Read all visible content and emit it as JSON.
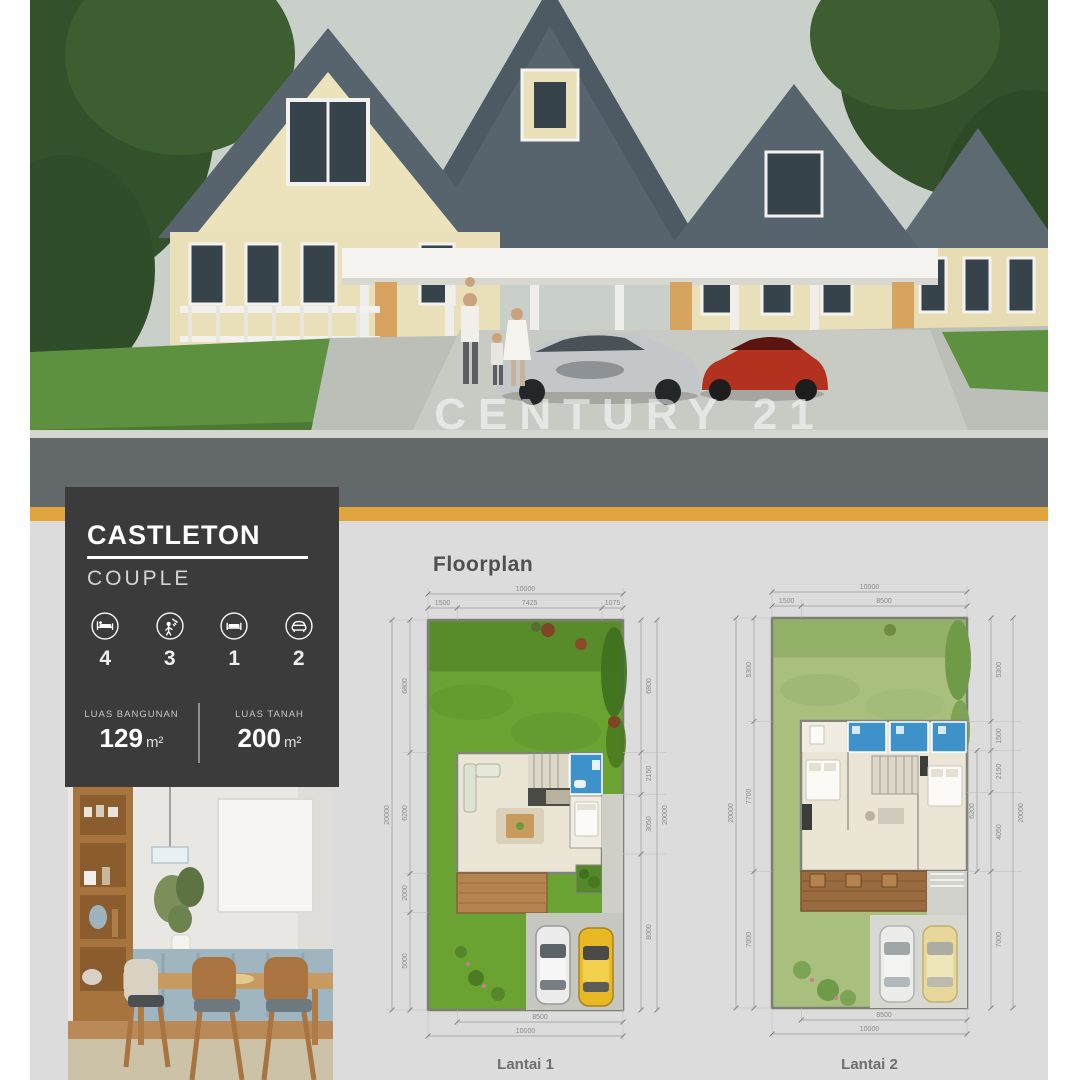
{
  "watermark": "CENTURY 21",
  "card": {
    "title": "CASTLETON",
    "subtitle": "COUPLE",
    "stats": [
      {
        "icon": "bed-icon",
        "value": "4"
      },
      {
        "icon": "bath-icon",
        "value": "3"
      },
      {
        "icon": "sofa-icon",
        "value": "1"
      },
      {
        "icon": "car-icon",
        "value": "2"
      }
    ],
    "areas": [
      {
        "label": "LUAS BANGUNAN",
        "value": "129",
        "unit": "m²"
      },
      {
        "label": "LUAS TANAH",
        "value": "200",
        "unit": "m²"
      }
    ]
  },
  "floorplan": {
    "heading": "Floorplan",
    "plans": [
      {
        "label": "Lantai 1",
        "top_total": "10000",
        "top_segments": [
          "1500",
          "7425",
          "1075"
        ],
        "left_total": "20000",
        "left_segments": [
          "6800",
          "6200",
          "2000",
          "5000"
        ],
        "right_total": "20000",
        "right_segments": [
          "6800",
          "2150",
          "3050",
          "8000"
        ],
        "bottom_inner": "8500",
        "bottom_total": "10000"
      },
      {
        "label": "Lantai 2",
        "top_total": "10000",
        "top_segments": [
          "1500",
          "8500"
        ],
        "left_total": "20000",
        "left_segments": [
          "5300",
          "7700",
          "7000"
        ],
        "right_total": "20000",
        "right_segments": [
          "5300",
          "1500",
          "2150",
          "4050",
          "7000"
        ],
        "right_inner": "6200",
        "bottom_inner": "8500",
        "bottom_total": "10000"
      }
    ]
  },
  "colors": {
    "accent_gold": "#dfa53c",
    "card_background": "#3b3b3c",
    "page_gray": "#dcdcdc",
    "grass_green": "#6aa332",
    "sage_green": "#a9bf7e",
    "bathroom_blue": "#3d93c9",
    "deck_brown": "#b5834f"
  }
}
